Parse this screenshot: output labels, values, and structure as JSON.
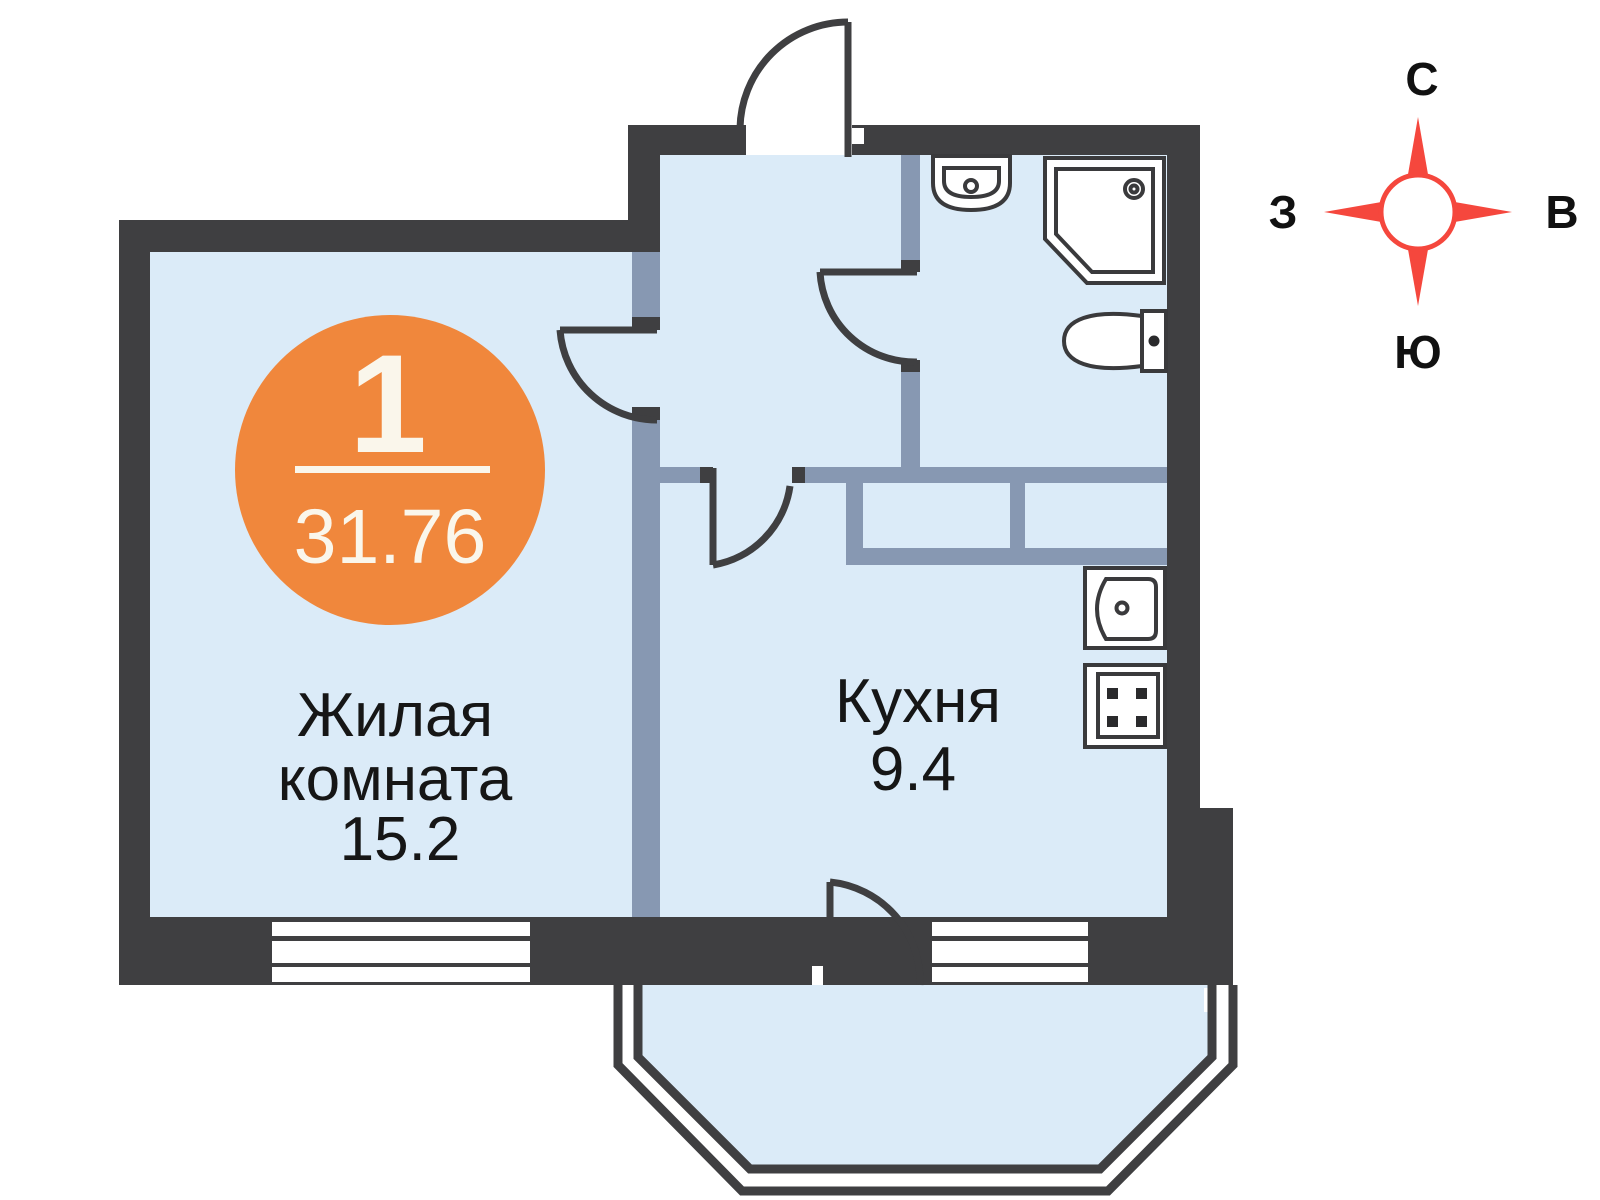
{
  "badge": {
    "room_count": "1",
    "total_area": "31.76"
  },
  "rooms": {
    "living": {
      "label_line1": "Жилая",
      "label_line2": "комната",
      "area": "15.2"
    },
    "kitchen": {
      "label": "Кухня",
      "area": "9.4"
    }
  },
  "compass": {
    "north": "С",
    "east": "В",
    "south": "Ю",
    "west": "З"
  },
  "fixtures": {
    "bathroom": [
      "washbasin",
      "shower",
      "toilet"
    ],
    "kitchen": [
      "sink",
      "stove"
    ]
  },
  "colors": {
    "wall_dark": "#3F3F41",
    "partition": "#8798B2",
    "room_fill": "#DBEBF8",
    "badge_orange": "#F0873C",
    "badge_text": "#FAF6EB",
    "compass_red": "#F5473D",
    "label_text": "#161616"
  }
}
